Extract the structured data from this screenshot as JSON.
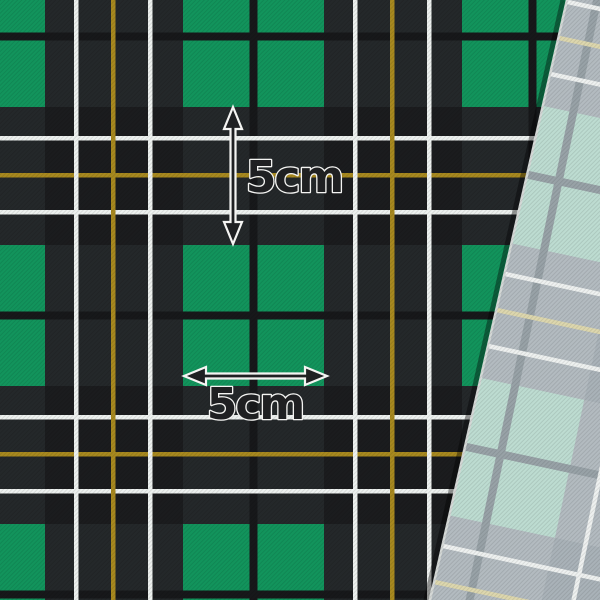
{
  "annotations": {
    "vertical_measurement": {
      "label": "5cm"
    },
    "horizontal_measurement": {
      "label": "5cm"
    },
    "text_fill": "#1f2022",
    "text_outline": "#f4f4f2",
    "arrow_fill": "#1f2022",
    "arrow_outline": "#f4f4f2"
  },
  "main_fabric": {
    "name": "green black tartan check",
    "colors": {
      "base": "#1b1c1e",
      "overcheck": "#24282a",
      "block": "#12945c",
      "divider": "#17181a",
      "stripe_white": "#edf1ef",
      "stripe_gold": "#a8891f"
    }
  },
  "secondary_fabric": {
    "name": "gray mint tartan check",
    "colors": {
      "base": "#a9b2b8",
      "overcheck": "#b3bbc0",
      "block": "#bddcd1",
      "divider": "#98a2a7",
      "stripe_white": "#eef1f0",
      "stripe_gold": "#ddd7ae"
    },
    "rotation_deg": 12,
    "edge_highlight": "#d5d9d7",
    "edge_shadow": "rgba(0,0,0,0.38)"
  },
  "pattern_geometry": {
    "tile": 279,
    "block": 141,
    "divider_start": 66.5,
    "divider_width": 8,
    "stripe_width": 4.5,
    "white_stripe_offsets": [
      170,
      244
    ],
    "gold_stripe_offset": 207,
    "main_origin": {
      "x": 183,
      "y": 245
    },
    "secondary_origin": {
      "x": 234.6,
      "y": 269.7
    }
  }
}
